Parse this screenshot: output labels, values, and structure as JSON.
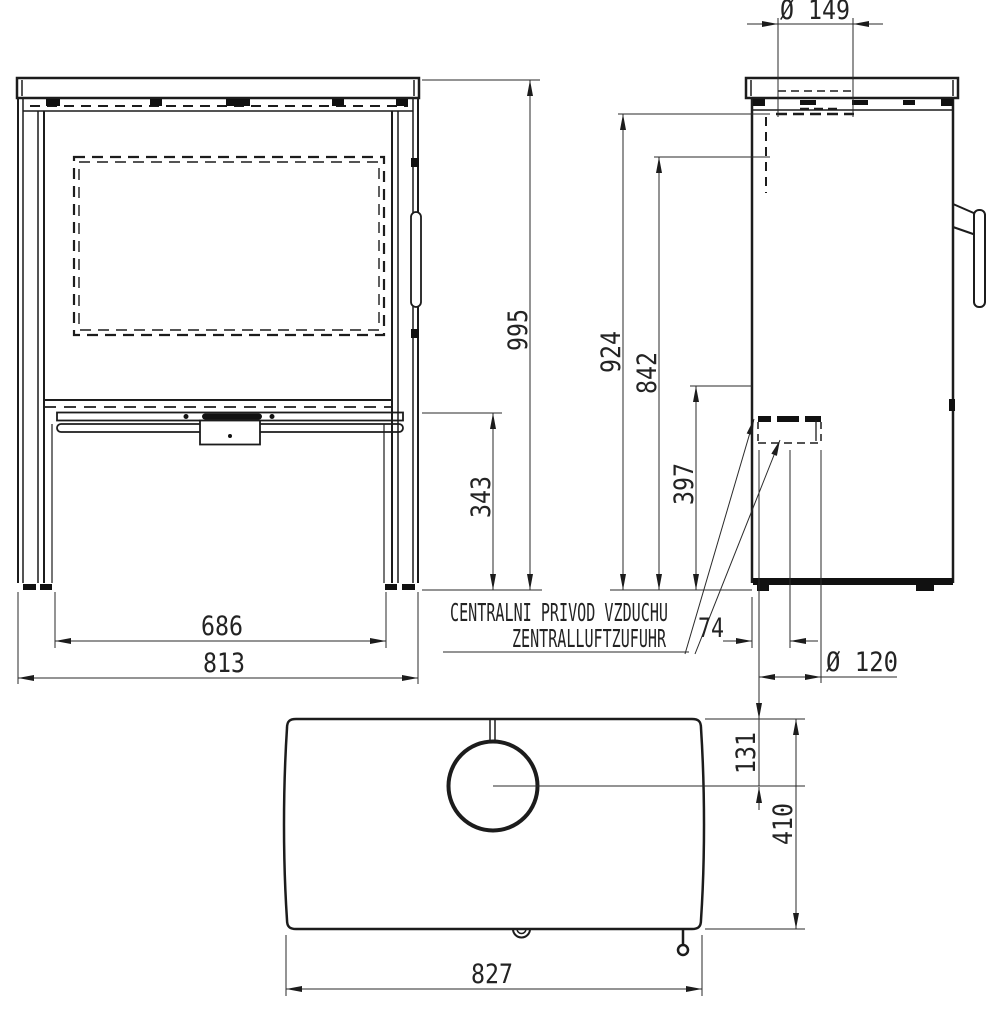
{
  "front": {
    "overall_height": "995",
    "base_height": "343",
    "inner_width": "686",
    "overall_width": "813"
  },
  "side": {
    "flue_diameter": "Ø 149",
    "rear_flue_height": "924",
    "rear_flue_center_height": "842",
    "air_inlet_height": "397",
    "air_inlet_back_offset": "74",
    "air_inlet_diameter": "Ø 120"
  },
  "top": {
    "flue_center_from_back": "131",
    "depth": "410",
    "width": "827"
  },
  "labels": {
    "air_supply_cz": "CENTRALNI PRIVOD VZDUCHU",
    "air_supply_de": "ZENTRALLUFTZUFUHR"
  },
  "colors": {
    "line": "#1c1c1c",
    "dimension_line": "#2a2a2a",
    "background": "#ffffff"
  }
}
